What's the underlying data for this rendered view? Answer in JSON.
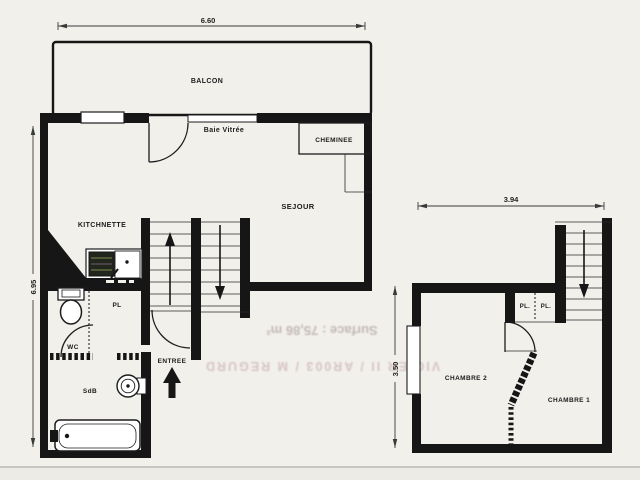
{
  "colors": {
    "paper": "#f2f0ea",
    "ink": "#161616",
    "bleed1": "#a09094",
    "bleed2": "#c09aa5"
  },
  "plans": {
    "left": {
      "rooms": {
        "balcon": "BALCON",
        "sejour": "SEJOUR",
        "kitchnette": "KITCHNETTE",
        "cheminee": "CHEMINEE",
        "wc": "WC",
        "pl": "PL",
        "sdb": "SdB",
        "entree": "ENTREE"
      },
      "window_label": "Baie Vitrée",
      "dim_width": "6.60",
      "dim_height": "6.95"
    },
    "right": {
      "rooms": {
        "chambre1": "CHAMBRE 1",
        "chambre2": "CHAMBRE 2",
        "pl_left": "PL.",
        "pl_right": "PL."
      },
      "dim_width": "3.94",
      "dim_height": "3.50"
    }
  },
  "bleed_through": {
    "line1": "Surface : 75,86 m²",
    "line2": "VIGIER II / AR003 / M REGURD"
  }
}
